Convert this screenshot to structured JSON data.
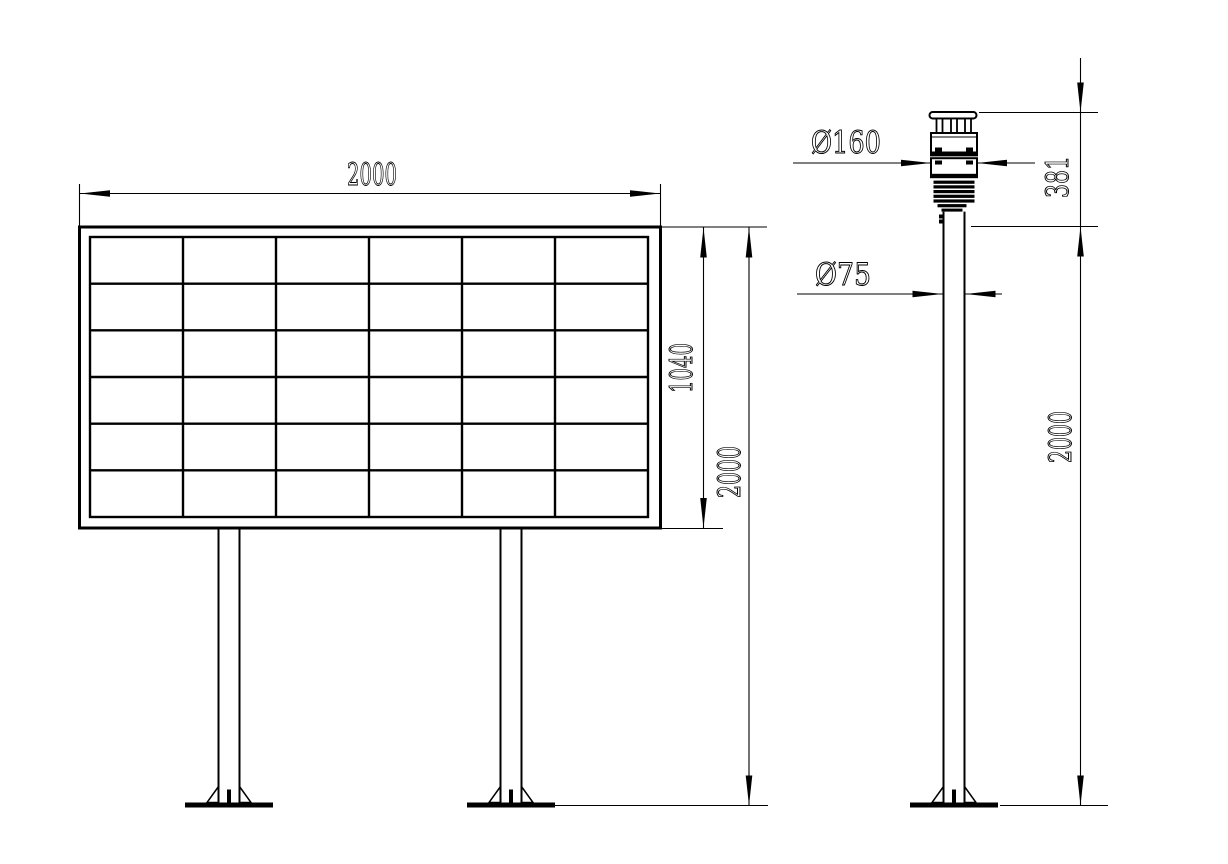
{
  "colors": {
    "line": "#000000",
    "background": "#ffffff"
  },
  "front_view": {
    "description": "display board front view",
    "grid": {
      "columns": 6,
      "rows": 6
    },
    "dim_width": "2000",
    "dim_panel_height": "1040",
    "dim_total_height": "2000"
  },
  "side_view": {
    "description": "sensor pole side view",
    "dim_sensor_diameter": "Ø160",
    "dim_pole_diameter": "Ø75",
    "dim_sensor_height": "381",
    "dim_pole_height": "2000"
  }
}
